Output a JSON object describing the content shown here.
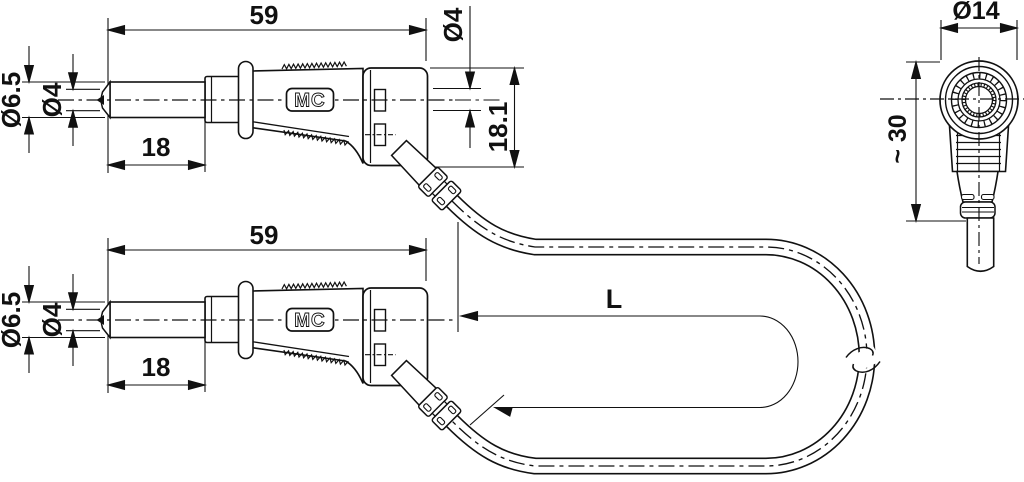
{
  "drawing": {
    "type": "technical-dimension-drawing",
    "colors": {
      "line": "#111111",
      "background": "#ffffff"
    },
    "straight_plug": {
      "logo": "MC",
      "overall_length": "59",
      "pin_length": "18",
      "sleeve_diameter": "Ø6.5",
      "pin_diameter": "Ø4",
      "rear_socket_diameter": "Ø4",
      "body_height": "18.1"
    },
    "angled_plug": {
      "head_diameter": "Ø14",
      "length": "~ 30"
    },
    "cable": {
      "length_label": "L"
    }
  }
}
